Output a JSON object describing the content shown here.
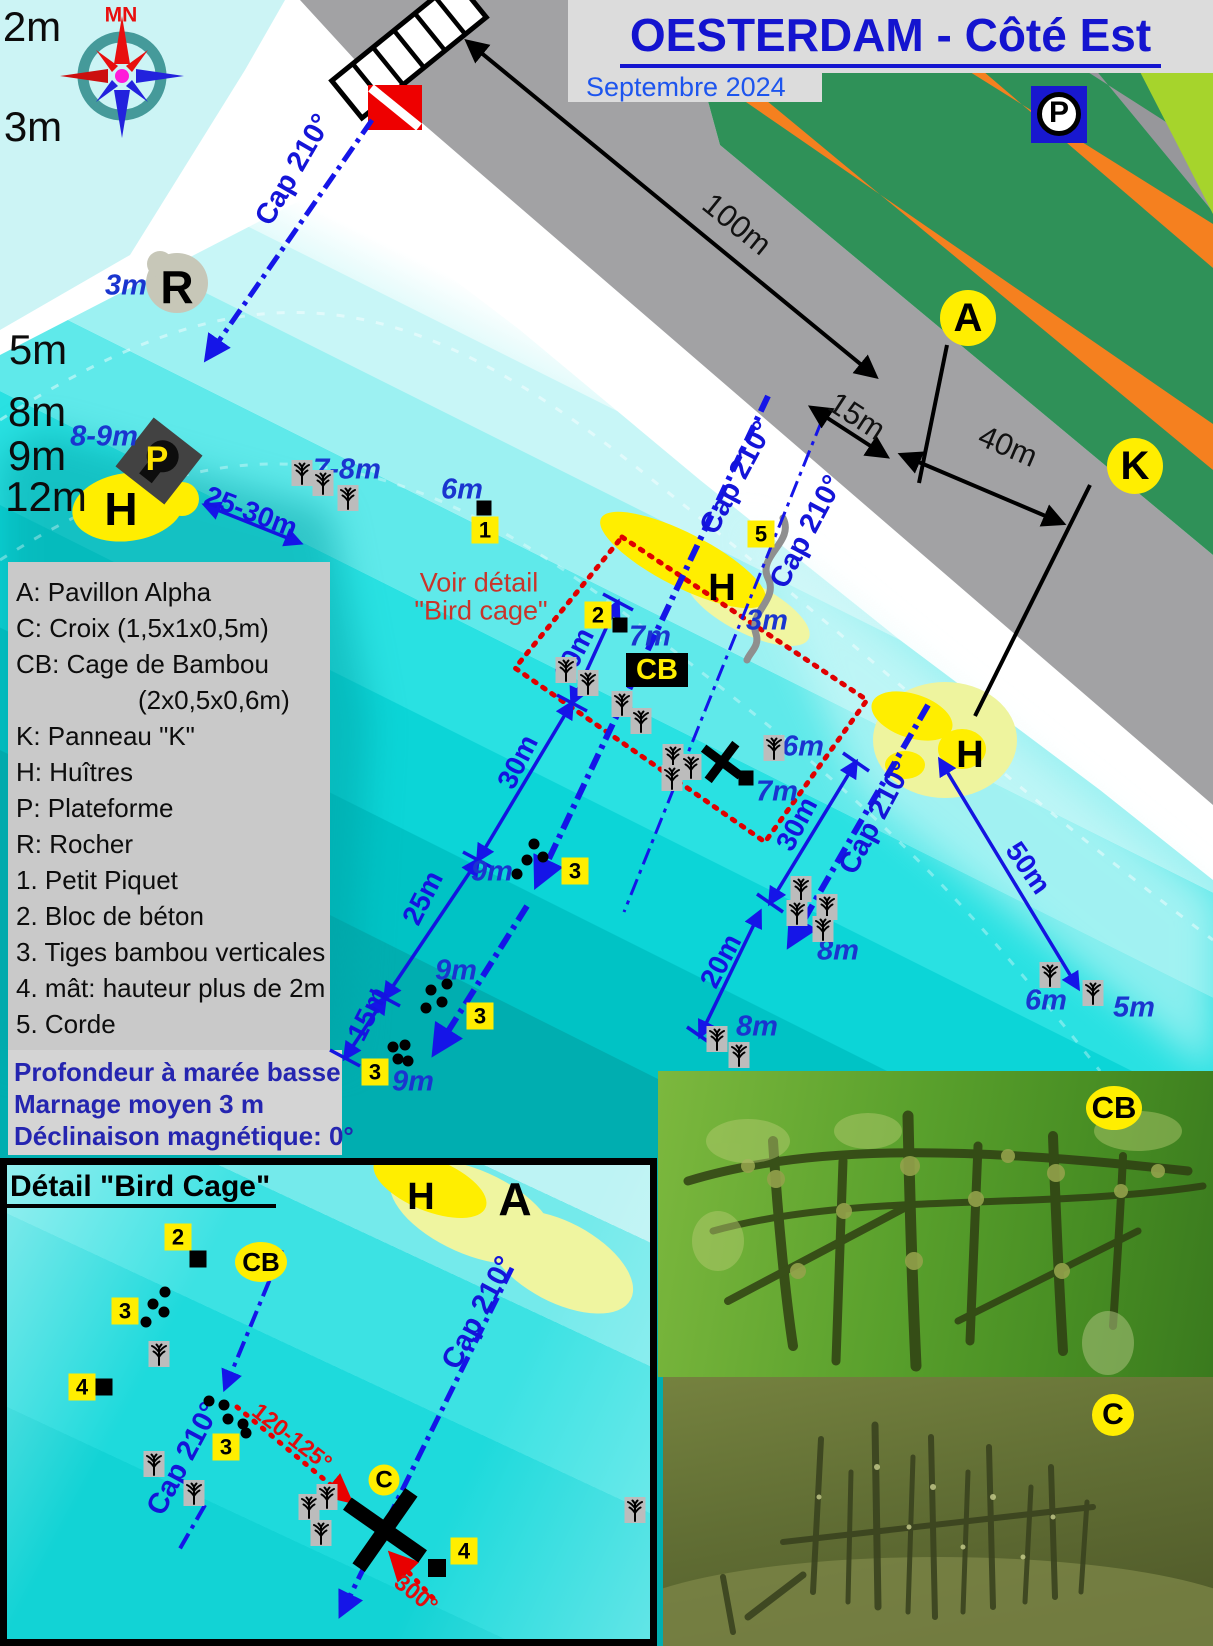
{
  "header": {
    "title": "OESTERDAM - Côté Est",
    "subtitle": "Septembre 2024"
  },
  "inset": {
    "title": "Détail \"Bird Cage\""
  },
  "legend": {
    "items": [
      "A: Pavillon Alpha",
      "C: Croix (1,5x1x0,5m)",
      "CB: Cage de Bambou",
      "(2x0,5x0,6m)",
      "K: Panneau \"K\"",
      "H: Huîtres",
      "P: Plateforme",
      "R: Rocher",
      "1. Petit Piquet",
      "2. Bloc de béton",
      "3. Tiges bambou verticales",
      "4. mât: hauteur plus de 2m",
      "5. Corde"
    ]
  },
  "notes": {
    "lines": [
      "Profondeur à marée basse",
      "Marnage moyen 3 m",
      "Déclinaison magnétique: 0°"
    ]
  },
  "colors": {
    "accent_blue": "#1414d8",
    "water_deep": "#00a8aa",
    "water_shallow": "#d9f9f9",
    "marker_yellow": "#ffee00",
    "alert_red": "#e00000"
  },
  "map": {
    "labels": [
      {
        "t": "2m",
        "x": 32,
        "y": 27,
        "cls": "dep",
        "n": "depth-label"
      },
      {
        "t": "3m",
        "x": 33,
        "y": 127,
        "cls": "dep",
        "n": "depth-label"
      },
      {
        "t": "5m",
        "x": 38,
        "y": 350,
        "cls": "dep",
        "n": "depth-label"
      },
      {
        "t": "8m",
        "x": 37,
        "y": 412,
        "cls": "dep",
        "n": "depth-label"
      },
      {
        "t": "9m",
        "x": 37,
        "y": 456,
        "cls": "dep",
        "n": "depth-label"
      },
      {
        "t": "12m",
        "x": 46,
        "y": 497,
        "cls": "dep",
        "n": "depth-label"
      },
      {
        "t": "MN",
        "x": 121,
        "y": 15,
        "cls": "mn",
        "n": "compass-north-label"
      },
      {
        "t": "R",
        "x": 177,
        "y": 287,
        "cls": "let",
        "n": "rock-label"
      },
      {
        "t": "3m",
        "x": 126,
        "y": 286,
        "cls": "bi",
        "n": "depth-note"
      },
      {
        "t": "H",
        "x": 121,
        "y": 509,
        "cls": "let",
        "n": "oyster-label"
      },
      {
        "t": "8-9m",
        "x": 104,
        "y": 437,
        "cls": "bi",
        "n": "depth-note"
      },
      {
        "t": "P",
        "x": 157,
        "y": 459,
        "cls": "ylw",
        "n": "platform-label"
      },
      {
        "t": "7-8m",
        "x": 347,
        "y": 470,
        "cls": "bi",
        "n": "depth-note"
      },
      {
        "t": "6m",
        "x": 462,
        "y": 490,
        "cls": "bi",
        "n": "depth-note"
      },
      {
        "t": "25-30m",
        "x": 251,
        "y": 512,
        "cls": "meas",
        "r": 21,
        "n": "distance-label"
      },
      {
        "t": "Cap 210°",
        "x": 294,
        "y": 170,
        "cls": "cap",
        "r": -60,
        "n": "heading-label"
      },
      {
        "t": "100m",
        "x": 737,
        "y": 224,
        "cls": "mb",
        "r": 39,
        "n": "distance-label"
      },
      {
        "t": "15m",
        "x": 857,
        "y": 416,
        "cls": "mb",
        "r": 33,
        "n": "distance-label"
      },
      {
        "t": "40m",
        "x": 1008,
        "y": 446,
        "cls": "mb",
        "r": 23,
        "n": "distance-label"
      },
      {
        "t": "P",
        "x": 1059,
        "y": 113,
        "cls": "pk",
        "n": "parking-label"
      },
      {
        "t": "Voir détail",
        "x": 479,
        "y": 583,
        "cls": "red1",
        "n": "see-detail-note"
      },
      {
        "t": "\"Bird cage\"",
        "x": 481,
        "y": 611,
        "cls": "red1",
        "n": "see-detail-note"
      },
      {
        "t": "7m",
        "x": 650,
        "y": 637,
        "cls": "bi",
        "n": "depth-note"
      },
      {
        "t": "H",
        "x": 722,
        "y": 588,
        "cls": "let2",
        "n": "oyster-label"
      },
      {
        "t": "3m",
        "x": 767,
        "y": 621,
        "cls": "bi",
        "n": "depth-note"
      },
      {
        "t": "Cap 210°",
        "x": 737,
        "y": 478,
        "cls": "cap",
        "r": -62,
        "n": "heading-label"
      },
      {
        "t": "Cap 210°",
        "x": 807,
        "y": 532,
        "cls": "cap",
        "r": -62,
        "n": "heading-label"
      },
      {
        "t": "Cap 210°",
        "x": 876,
        "y": 818,
        "cls": "cap",
        "r": -62,
        "n": "heading-label"
      },
      {
        "t": "6m",
        "x": 803,
        "y": 747,
        "cls": "bi",
        "n": "depth-note"
      },
      {
        "t": "7m",
        "x": 777,
        "y": 792,
        "cls": "bi",
        "n": "depth-note"
      },
      {
        "t": "10m",
        "x": 574,
        "y": 655,
        "cls": "meas",
        "r": -63,
        "n": "distance-label"
      },
      {
        "t": "30m",
        "x": 518,
        "y": 762,
        "cls": "meas",
        "r": -63,
        "n": "distance-label"
      },
      {
        "t": "25m",
        "x": 423,
        "y": 898,
        "cls": "meas",
        "r": -63,
        "n": "distance-label"
      },
      {
        "t": "15m",
        "x": 368,
        "y": 1014,
        "cls": "meas",
        "r": -63,
        "n": "distance-label"
      },
      {
        "t": "9m",
        "x": 492,
        "y": 872,
        "cls": "bi",
        "n": "depth-note"
      },
      {
        "t": "9m",
        "x": 456,
        "y": 971,
        "cls": "bi",
        "n": "depth-note"
      },
      {
        "t": "9m",
        "x": 413,
        "y": 1082,
        "cls": "bi",
        "n": "depth-note"
      },
      {
        "t": "30m",
        "x": 797,
        "y": 824,
        "cls": "meas",
        "r": -62,
        "n": "distance-label"
      },
      {
        "t": "20m",
        "x": 721,
        "y": 961,
        "cls": "meas",
        "r": -62,
        "n": "distance-label"
      },
      {
        "t": "8m",
        "x": 838,
        "y": 951,
        "cls": "bi",
        "n": "depth-note"
      },
      {
        "t": "8m",
        "x": 757,
        "y": 1027,
        "cls": "bi",
        "n": "depth-note"
      },
      {
        "t": "H",
        "x": 970,
        "y": 755,
        "cls": "let2",
        "n": "oyster-label"
      },
      {
        "t": "50m",
        "x": 1028,
        "y": 868,
        "cls": "meas",
        "r": 55,
        "n": "distance-label"
      },
      {
        "t": "6m",
        "x": 1046,
        "y": 1001,
        "cls": "bi",
        "n": "depth-note"
      },
      {
        "t": "5m",
        "x": 1134,
        "y": 1008,
        "cls": "bi",
        "n": "depth-note"
      },
      {
        "t": "H",
        "x": 421,
        "y": 1197,
        "cls": "let2",
        "n": "oyster-label"
      },
      {
        "t": "A",
        "x": 515,
        "y": 1199,
        "cls": "let",
        "n": "alpha-label"
      },
      {
        "t": "Cap 210°",
        "x": 479,
        "y": 1313,
        "cls": "cap",
        "r": -62,
        "n": "heading-label"
      },
      {
        "t": "Cap 210°",
        "x": 184,
        "y": 1459,
        "cls": "cap",
        "r": -62,
        "n": "heading-label"
      },
      {
        "t": "120-125°",
        "x": 292,
        "y": 1437,
        "cls": "redr",
        "r": 38,
        "n": "bearing-label"
      },
      {
        "t": "300°",
        "x": 416,
        "y": 1594,
        "cls": "redr",
        "r": 38,
        "n": "bearing-label"
      }
    ],
    "badges": [
      {
        "t": "A",
        "x": 968,
        "y": 318,
        "k": "bcirc",
        "n": "pavillon-alpha-badge"
      },
      {
        "t": "K",
        "x": 1135,
        "y": 466,
        "k": "bcirc",
        "n": "panneau-k-badge"
      },
      {
        "t": "1",
        "x": 485,
        "y": 530,
        "k": "bsq",
        "n": "petit-piquet-badge"
      },
      {
        "t": "2",
        "x": 598,
        "y": 615,
        "k": "bsq",
        "n": "bloc-beton-badge"
      },
      {
        "t": "5",
        "x": 761,
        "y": 534,
        "k": "bsq",
        "n": "corde-badge"
      },
      {
        "t": "3",
        "x": 575,
        "y": 871,
        "k": "bsq",
        "n": "tiges-bambou-badge"
      },
      {
        "t": "3",
        "x": 480,
        "y": 1016,
        "k": "bsq",
        "n": "tiges-bambou-badge"
      },
      {
        "t": "3",
        "x": 375,
        "y": 1072,
        "k": "bsq",
        "n": "tiges-bambou-badge"
      },
      {
        "t": "CB",
        "x": 657,
        "y": 670,
        "k": "bblack",
        "n": "cage-bambou-badge"
      },
      {
        "t": "2",
        "x": 178,
        "y": 1237,
        "k": "bsq",
        "n": "bloc-beton-badge"
      },
      {
        "t": "CB",
        "x": 261,
        "y": 1262,
        "k": "bell",
        "n": "cage-bambou-badge"
      },
      {
        "t": "3",
        "x": 125,
        "y": 1311,
        "k": "bsq",
        "n": "tiges-bambou-badge"
      },
      {
        "t": "4",
        "x": 82,
        "y": 1387,
        "k": "bsq",
        "n": "mat-badge"
      },
      {
        "t": "3",
        "x": 226,
        "y": 1447,
        "k": "bsq",
        "n": "tiges-bambou-badge"
      },
      {
        "t": "C",
        "x": 384,
        "y": 1480,
        "k": "bcircsm",
        "n": "croix-badge"
      },
      {
        "t": "4",
        "x": 464,
        "y": 1551,
        "k": "bsq",
        "n": "mat-badge"
      },
      {
        "t": "CB",
        "x": 1114,
        "y": 1108,
        "k": "bellg",
        "n": "photo-cage-badge"
      },
      {
        "t": "C",
        "x": 1113,
        "y": 1415,
        "k": "bcircp",
        "n": "photo-croix-badge"
      }
    ],
    "bamboo": [
      [
        302,
        473
      ],
      [
        323,
        483
      ],
      [
        348,
        498
      ],
      [
        566,
        670
      ],
      [
        588,
        683
      ],
      [
        622,
        704
      ],
      [
        641,
        721
      ],
      [
        673,
        757
      ],
      [
        691,
        767
      ],
      [
        672,
        778
      ],
      [
        774,
        748
      ],
      [
        801,
        889
      ],
      [
        797,
        913
      ],
      [
        827,
        907
      ],
      [
        823,
        929
      ],
      [
        717,
        1039
      ],
      [
        739,
        1055
      ],
      [
        1050,
        975
      ],
      [
        1093,
        993
      ],
      [
        159,
        1354
      ],
      [
        154,
        1464
      ],
      [
        194,
        1493
      ],
      [
        309,
        1507
      ],
      [
        327,
        1497
      ],
      [
        321,
        1533
      ],
      [
        635,
        1510
      ]
    ],
    "stake_dots": [
      [
        534,
        844
      ],
      [
        543,
        857
      ],
      [
        527,
        860
      ],
      [
        517,
        874
      ],
      [
        447,
        984
      ],
      [
        431,
        990
      ],
      [
        442,
        1002
      ],
      [
        426,
        1008
      ],
      [
        393,
        1047
      ],
      [
        405,
        1045
      ],
      [
        398,
        1059
      ],
      [
        408,
        1061
      ],
      [
        165,
        1292
      ],
      [
        153,
        1304
      ],
      [
        164,
        1312
      ],
      [
        146,
        1322
      ],
      [
        209,
        1401
      ],
      [
        224,
        1405
      ],
      [
        228,
        1419
      ],
      [
        243,
        1424
      ],
      [
        246,
        1433
      ]
    ],
    "concrete_blocks": [
      [
        484,
        508,
        15
      ],
      [
        620,
        625,
        15
      ],
      [
        746,
        778,
        15
      ],
      [
        198,
        1259,
        17
      ],
      [
        104,
        1387,
        17
      ],
      [
        437,
        1568,
        18
      ]
    ],
    "crosses": [
      {
        "x": 722,
        "y": 762,
        "s": 46,
        "w": 9,
        "r": -8
      },
      {
        "x": 385,
        "y": 1530,
        "s": 92,
        "w": 15,
        "r": -10
      }
    ]
  }
}
